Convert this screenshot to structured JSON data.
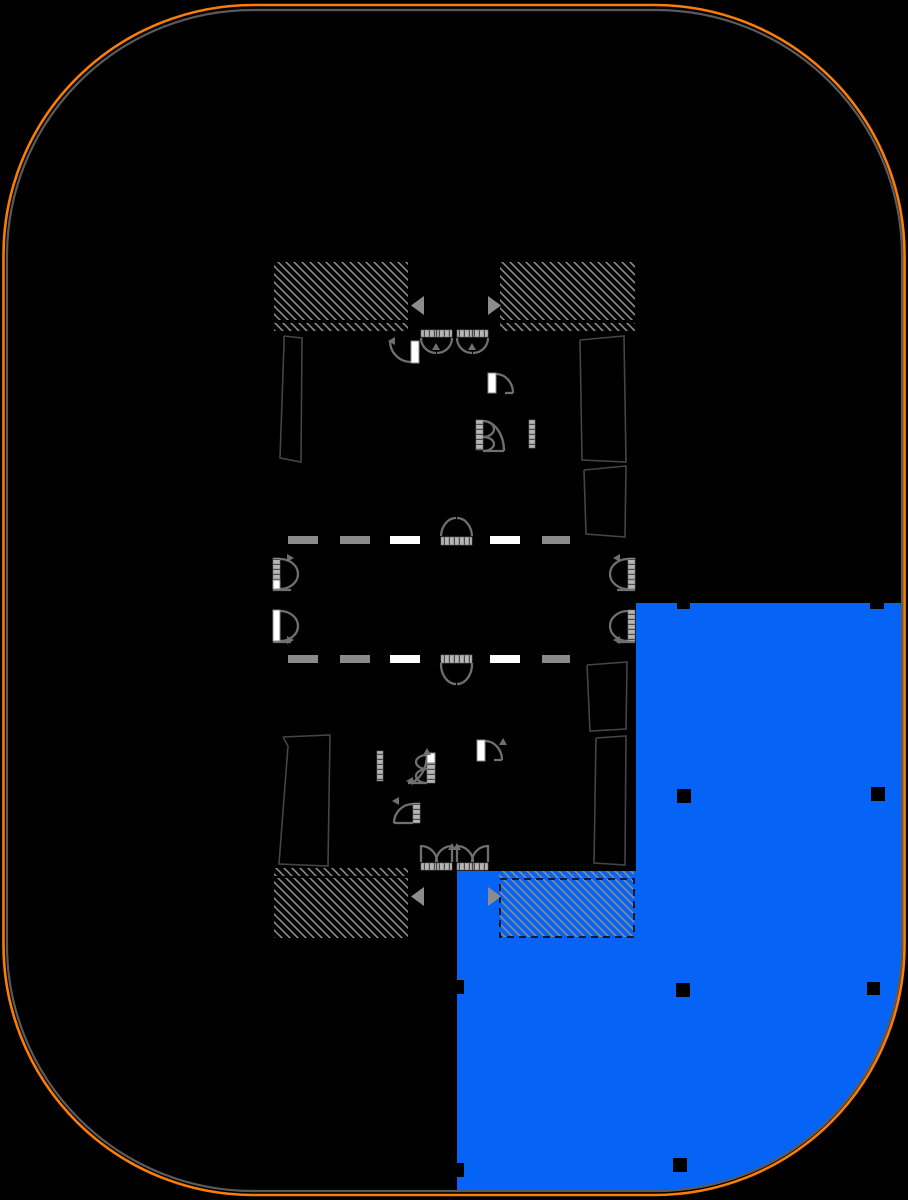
{
  "canvas": {
    "width": 908,
    "height": 1200,
    "background": "#000000"
  },
  "colors": {
    "background": "#000000",
    "site_boundary": "#f97d07",
    "building_outline": "#5a5a5a",
    "selected_unit_fill": "#0563f5",
    "hatch_line": "#8c8c8c",
    "door_stroke": "#6f6f6f",
    "leaf_white": "#ffffff",
    "leaf_gray": "#b5b5b5",
    "leaf_tick": "#4a4a4a",
    "dash_gray": "#8a8a8a",
    "dash_white": "#ffffff",
    "room_line": "#454545",
    "column_fill": "#000000",
    "arrow_fill": "#8c8c8c",
    "shaft_dash_stroke": "#000000"
  },
  "site_boundary": {
    "x": 3.5,
    "y": 5,
    "w": 901,
    "h": 1190,
    "r": 250,
    "stroke_width": 2.6
  },
  "building_outline": {
    "x": 7,
    "y": 10,
    "w": 895,
    "h": 1181,
    "r": 246,
    "stroke_width": 2.2
  },
  "selected_unit": {
    "path": "M636,603 L902,603 L902,946 A244,244 0 0 1 658,1190 L457,1190 L457,871 L636,871 Z"
  },
  "stair_shafts": [
    {
      "id": "stair-shaft-top-left",
      "x": 274,
      "y": 262,
      "w": 134,
      "h": 58,
      "dashed": false
    },
    {
      "id": "stair-shaft-top-right",
      "x": 500,
      "y": 262,
      "w": 135,
      "h": 58,
      "dashed": false
    },
    {
      "id": "stair-shaft-bottom-left",
      "x": 274,
      "y": 878,
      "w": 134,
      "h": 60,
      "dashed": false
    },
    {
      "id": "stair-shaft-bottom-right-dashed",
      "x": 500,
      "y": 879,
      "w": 134,
      "h": 58,
      "dashed": true
    }
  ],
  "hatch_bands": [
    {
      "x": 274,
      "y": 323,
      "w": 134,
      "h": 8
    },
    {
      "x": 500,
      "y": 323,
      "w": 135,
      "h": 8
    },
    {
      "x": 274,
      "y": 868,
      "w": 134,
      "h": 8
    },
    {
      "x": 499,
      "y": 871,
      "w": 135,
      "h": 7
    }
  ],
  "shaft_entry_arrows": [
    {
      "points": "424,296 424,315 411,305.5"
    },
    {
      "points": "488,296 488,315 501,305.5"
    },
    {
      "points": "424,887 424,906 411,896.5"
    },
    {
      "points": "488,887 488,906 501,896.5"
    }
  ],
  "corridor_lines": [
    {
      "id": "corridor-dashed-line-upper",
      "y": 536,
      "h": 8,
      "dashes": [
        {
          "x": 288,
          "w": 30,
          "c": "gray"
        },
        {
          "x": 340,
          "w": 30,
          "c": "gray"
        },
        {
          "x": 390,
          "w": 30,
          "c": "white"
        },
        {
          "x": 490,
          "w": 30,
          "c": "white"
        },
        {
          "x": 542,
          "w": 28,
          "c": "gray"
        }
      ]
    },
    {
      "id": "corridor-dashed-line-lower",
      "y": 655,
      "h": 8,
      "dashes": [
        {
          "x": 288,
          "w": 30,
          "c": "gray"
        },
        {
          "x": 340,
          "w": 30,
          "c": "gray"
        },
        {
          "x": 390,
          "w": 30,
          "c": "white"
        },
        {
          "x": 490,
          "w": 30,
          "c": "white"
        },
        {
          "x": 542,
          "w": 28,
          "c": "gray"
        }
      ]
    }
  ],
  "columns": [
    {
      "x": 677,
      "y": 603,
      "w": 13,
      "h": 6
    },
    {
      "x": 870,
      "y": 603,
      "w": 14,
      "h": 6
    },
    {
      "x": 677,
      "y": 789,
      "w": 14,
      "h": 14
    },
    {
      "x": 871,
      "y": 787,
      "w": 14,
      "h": 14
    },
    {
      "x": 676,
      "y": 983,
      "w": 14,
      "h": 14
    },
    {
      "x": 867,
      "y": 982,
      "w": 13,
      "h": 13
    },
    {
      "x": 673,
      "y": 1158,
      "w": 14,
      "h": 14
    },
    {
      "x": 450,
      "y": 980,
      "w": 14,
      "h": 14
    },
    {
      "x": 450,
      "y": 1163,
      "w": 14,
      "h": 14
    }
  ],
  "wall_bars": [
    {
      "x": 529,
      "y": 420,
      "w": 6,
      "h": 28,
      "fill": "ladder-v"
    },
    {
      "x": 377,
      "y": 751,
      "w": 6,
      "h": 30,
      "fill": "ladder-v"
    }
  ],
  "room_outlines": [
    {
      "points": "284,336 302,338 301,462 280,458 284,344 284,336"
    },
    {
      "points": "580,340 624,336 626,462 582,460 580,340"
    },
    {
      "points": "584,470 626,466 625,537 586,534 584,470"
    },
    {
      "points": "283,737 330,735 328,866 279,864 288,746 283,737"
    },
    {
      "points": "587,665 627,662 626,729 590,731 587,665"
    },
    {
      "points": "596,738 626,736 625,865 594,863 596,738"
    }
  ],
  "doors": [
    {
      "id": "door-lobby-top-left",
      "leaves": [
        {
          "x": 411,
          "y": 341,
          "w": 8,
          "h": 22,
          "fill": "white"
        }
      ],
      "paths": [
        "M411,362 A21,21 0 0 1 390,341"
      ],
      "arrows": [
        {
          "x": 388,
          "y": 341,
          "dir": "left"
        }
      ]
    },
    {
      "id": "door-elevator-top-1",
      "leaves": [
        {
          "x": 421,
          "y": 330,
          "w": 15,
          "h": 7,
          "fill": "ladder-h"
        },
        {
          "x": 437,
          "y": 330,
          "w": 15,
          "h": 7,
          "fill": "ladder-h"
        }
      ],
      "paths": [
        "M421,338 A15,15 0 0 0 436,353",
        "M452,338 A15,15 0 0 1 437,353"
      ],
      "arrows": [
        {
          "x": 436,
          "y": 343,
          "dir": "up"
        }
      ]
    },
    {
      "id": "door-elevator-top-2",
      "leaves": [
        {
          "x": 457,
          "y": 330,
          "w": 15,
          "h": 7,
          "fill": "ladder-h"
        },
        {
          "x": 473,
          "y": 330,
          "w": 15,
          "h": 7,
          "fill": "ladder-h"
        }
      ],
      "paths": [
        "M457,338 A15,15 0 0 0 472,353",
        "M488,338 A15,15 0 0 1 473,353"
      ],
      "arrows": [
        {
          "x": 472,
          "y": 343,
          "dir": "up"
        }
      ]
    },
    {
      "id": "door-core-upper-white",
      "leaves": [
        {
          "x": 488,
          "y": 373,
          "w": 8,
          "h": 20,
          "fill": "white"
        }
      ],
      "paths": [
        "M496,374 A17,19 0 0 1 513,393",
        "M505,393 L513,393"
      ],
      "arrows": []
    },
    {
      "id": "door-core-upper-gray",
      "leaves": [
        {
          "x": 476,
          "y": 420,
          "w": 7,
          "h": 30,
          "fill": "ladder-v"
        }
      ],
      "paths": [
        "M483,421 A11,8 0 0 1 483,437",
        "M483,437 A11,7 0 0 1 483,451",
        "M504,451 A21,30 0 0 0 483,421",
        "M483,451 L504,451"
      ],
      "arrows": []
    },
    {
      "id": "door-elevator-left-1",
      "leaves": [
        {
          "x": 273,
          "y": 558,
          "w": 7,
          "h": 22,
          "fill": "ladder-v"
        },
        {
          "x": 273,
          "y": 580,
          "w": 7,
          "h": 9,
          "fill": "white"
        }
      ],
      "paths": [
        "M280,559 A18,15 0 0 1 280,589",
        "M273,590 L291,590"
      ],
      "arrows": [
        {
          "x": 294,
          "y": 558,
          "dir": "right"
        }
      ]
    },
    {
      "id": "door-elevator-left-2",
      "leaves": [
        {
          "x": 273,
          "y": 610,
          "w": 7,
          "h": 31,
          "fill": "white"
        }
      ],
      "paths": [
        "M280,611 A18,15 0 0 1 280,641",
        "M273,642 L291,642"
      ],
      "arrows": [
        {
          "x": 294,
          "y": 640,
          "dir": "right"
        }
      ]
    },
    {
      "id": "door-elevator-right-1",
      "leaves": [
        {
          "x": 628,
          "y": 558,
          "w": 7,
          "h": 22,
          "fill": "ladder-v"
        },
        {
          "x": 628,
          "y": 580,
          "w": 7,
          "h": 9,
          "fill": "ladder-v"
        }
      ],
      "paths": [
        "M628,559 A18,15 0 0 0 628,589",
        "M617,590 L635,590"
      ],
      "arrows": [
        {
          "x": 613,
          "y": 558,
          "dir": "left"
        }
      ]
    },
    {
      "id": "door-elevator-right-2",
      "leaves": [
        {
          "x": 628,
          "y": 610,
          "w": 7,
          "h": 31,
          "fill": "ladder-v"
        }
      ],
      "paths": [
        "M628,611 A18,15 0 0 0 628,641",
        "M617,642 L635,642"
      ],
      "arrows": [
        {
          "x": 613,
          "y": 640,
          "dir": "left"
        }
      ]
    },
    {
      "id": "door-corridor-upper",
      "leaves": [
        {
          "x": 441,
          "y": 537,
          "w": 31,
          "h": 8,
          "fill": "ladder-h"
        }
      ],
      "paths": [
        "M441,536 A15,19 0 0 1 456,518",
        "M472,536 A15,19 0 0 0 457,518"
      ],
      "arrows": []
    },
    {
      "id": "door-corridor-lower",
      "leaves": [
        {
          "x": 441,
          "y": 655,
          "w": 31,
          "h": 8,
          "fill": "ladder-h"
        }
      ],
      "paths": [
        "M441,663 A15,20 0 0 0 456,684",
        "M472,663 A15,20 0 0 1 457,684"
      ],
      "arrows": []
    },
    {
      "id": "door-core-lower-double-swing",
      "leaves": [
        {
          "x": 427,
          "y": 753,
          "w": 8,
          "h": 10,
          "fill": "white"
        },
        {
          "x": 427,
          "y": 763,
          "w": 8,
          "h": 20,
          "fill": "ladder-v"
        }
      ],
      "paths": [
        "M427,755 A11,7 0 0 0 427,769",
        "M427,769 A11,7 0 0 0 427,783",
        "M408,783 A20,29 0 0 0 427,754",
        "M408,783 L427,783"
      ],
      "arrows": [
        {
          "x": 406,
          "y": 781,
          "dir": "left"
        },
        {
          "x": 427,
          "y": 748,
          "dir": "up"
        }
      ]
    },
    {
      "id": "door-core-lower-white",
      "leaves": [
        {
          "x": 477,
          "y": 740,
          "w": 8,
          "h": 21,
          "fill": "white"
        }
      ],
      "paths": [
        "M485,741 A17,19 0 0 1 502,760",
        "M494,760 L502,760"
      ],
      "arrows": [
        {
          "x": 503,
          "y": 738,
          "dir": "up"
        }
      ]
    },
    {
      "id": "door-core-bottom-gray",
      "leaves": [
        {
          "x": 413,
          "y": 803,
          "w": 7,
          "h": 20,
          "fill": "ladder-v"
        }
      ],
      "paths": [
        "M413,804 A19,19 0 0 0 394,823",
        "M394,823 L413,823"
      ],
      "arrows": [
        {
          "x": 392,
          "y": 801,
          "dir": "left"
        }
      ]
    },
    {
      "id": "door-entry-bottom-1",
      "leaves": [
        {
          "x": 421,
          "y": 863,
          "w": 15,
          "h": 7,
          "fill": "ladder-h"
        },
        {
          "x": 437,
          "y": 863,
          "w": 15,
          "h": 7,
          "fill": "ladder-h"
        }
      ],
      "paths": [
        "M421,845 L421,862",
        "M421,846 A16,16 0 0 1 437,862",
        "M452,845 L452,862",
        "M452,846 A16,16 0 0 0 436,862"
      ],
      "arrows": [
        {
          "x": 452,
          "y": 843,
          "dir": "up"
        }
      ]
    },
    {
      "id": "door-entry-bottom-2",
      "leaves": [
        {
          "x": 457,
          "y": 863,
          "w": 15,
          "h": 7,
          "fill": "ladder-h"
        },
        {
          "x": 473,
          "y": 863,
          "w": 15,
          "h": 7,
          "fill": "ladder-h"
        }
      ],
      "paths": [
        "M457,845 L457,862",
        "M457,846 A16,16 0 0 1 473,862",
        "M488,845 L488,862",
        "M488,846 A16,16 0 0 0 472,862"
      ],
      "arrows": [
        {
          "x": 457,
          "y": 843,
          "dir": "up"
        }
      ]
    }
  ]
}
